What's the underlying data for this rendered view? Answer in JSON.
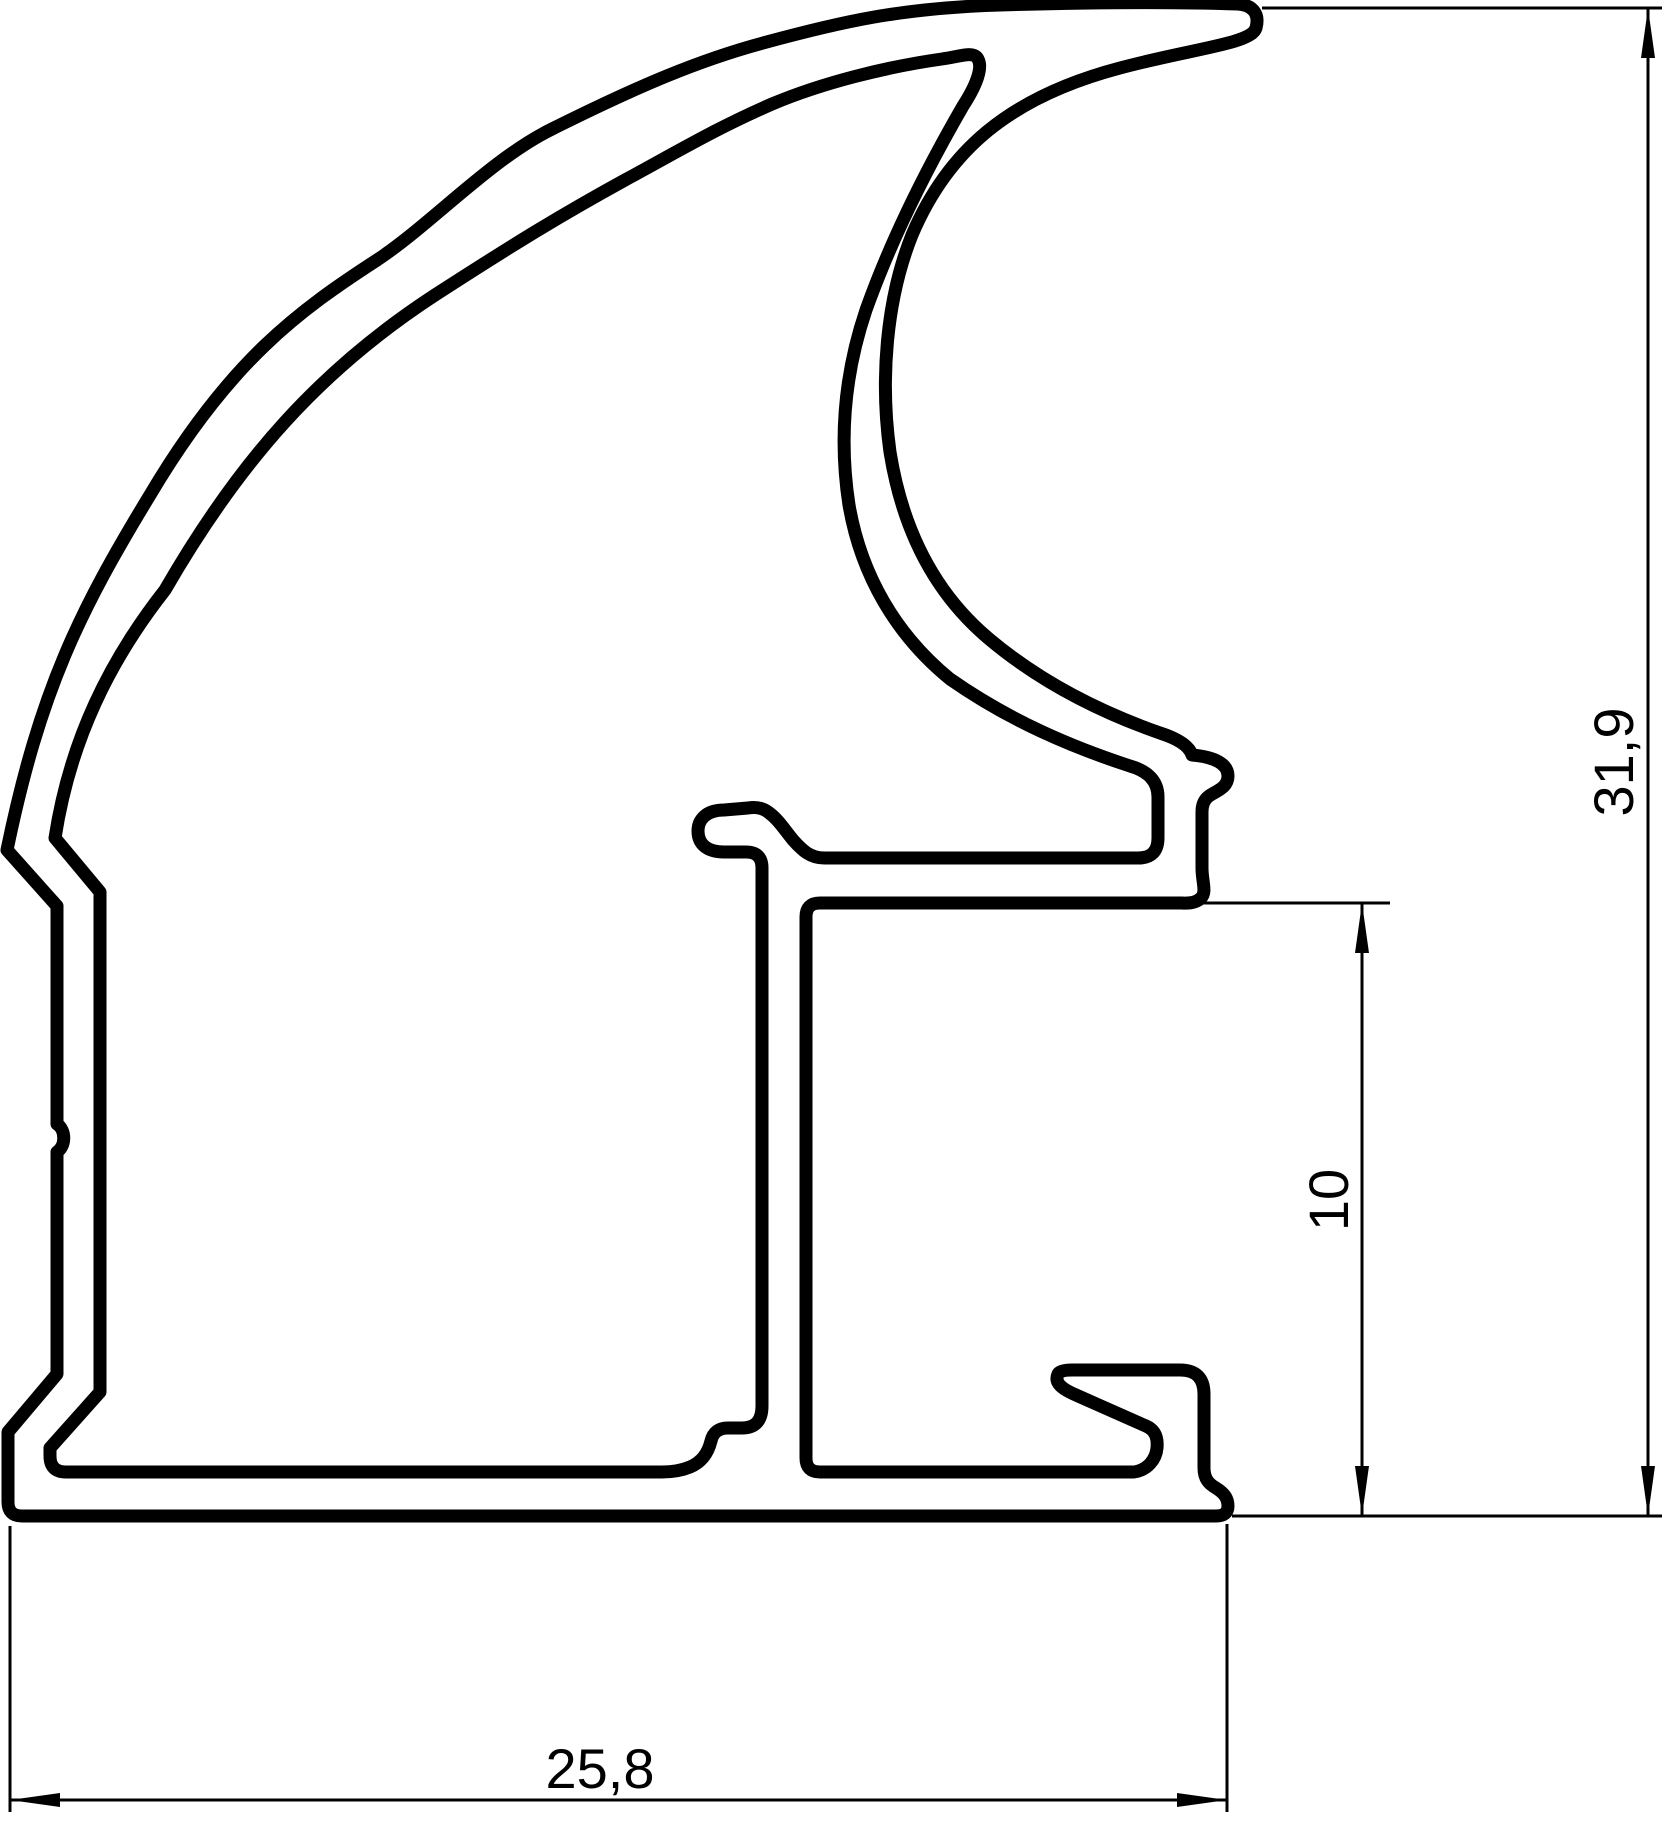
{
  "drawing": {
    "kind": "technical cross-section of an extrusion profile",
    "colors": {
      "line": "#000000",
      "background": "#ffffff"
    },
    "dimensions": {
      "overall_height": {
        "label": "31,9",
        "orientation": "vertical",
        "side": "right"
      },
      "slot_height": {
        "label": "10",
        "orientation": "vertical",
        "side": "inner-right"
      },
      "overall_width": {
        "label": "25,8",
        "orientation": "horizontal",
        "side": "bottom"
      }
    }
  }
}
